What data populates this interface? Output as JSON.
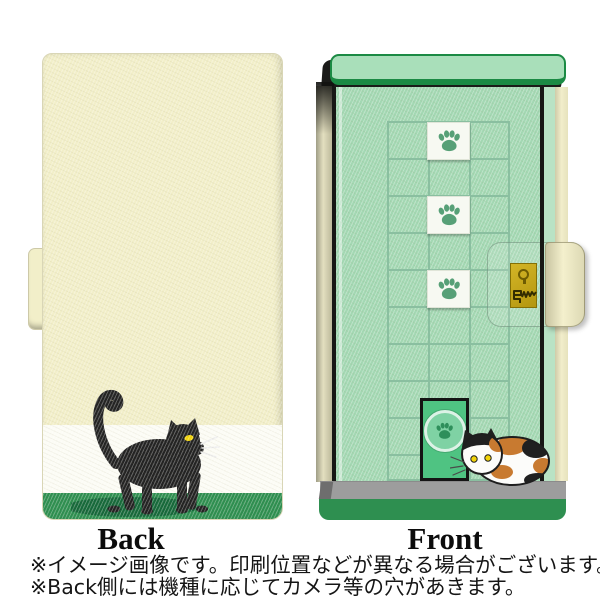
{
  "back_view": {
    "label": "Back"
  },
  "front_view": {
    "label": "Front",
    "paw_tiles": 3
  },
  "notes": {
    "line1": "※イメージ画像です。印刷位置などが異なる場合がございます。",
    "line2": "※Back側には機種に応じてカメラ等の穴があきます。"
  },
  "icons": {
    "paw_print": "paw-print-icon",
    "keyhole": "keyhole-icon",
    "scratch_marks": "scratch-marks-icon",
    "black_cat": "black-cat-illustration",
    "calico_cat": "calico-cat-illustration"
  },
  "colors": {
    "cream_case": "#f2efc9",
    "white_band": "#fcfcf5",
    "green_band": "#2e8f50",
    "shadow_green": "#16693a",
    "cat_black": "#232323",
    "eye_yellow": "#f2d40a",
    "mint_bar": "#a9dfba",
    "mint_door": "#a3d8b3",
    "mint_light": "#b9e3c5",
    "green_border": "#1b8a44",
    "frame_black": "#171715",
    "grid_line": "#8abfa0",
    "tile_white": "#f7f9f2",
    "paw_green": "#57a077",
    "catdoor_green": "#4fc382",
    "catdoor_circle": "#7fd2a4",
    "catdoor_ring": "#dcf2e6",
    "catdoor_paw": "#2e8f5b",
    "gold_dark": "#6e5c02",
    "floor_gray": "#9d9d9d",
    "floor_dark": "#6e6e6e",
    "calico_orange": "#c87a30"
  }
}
